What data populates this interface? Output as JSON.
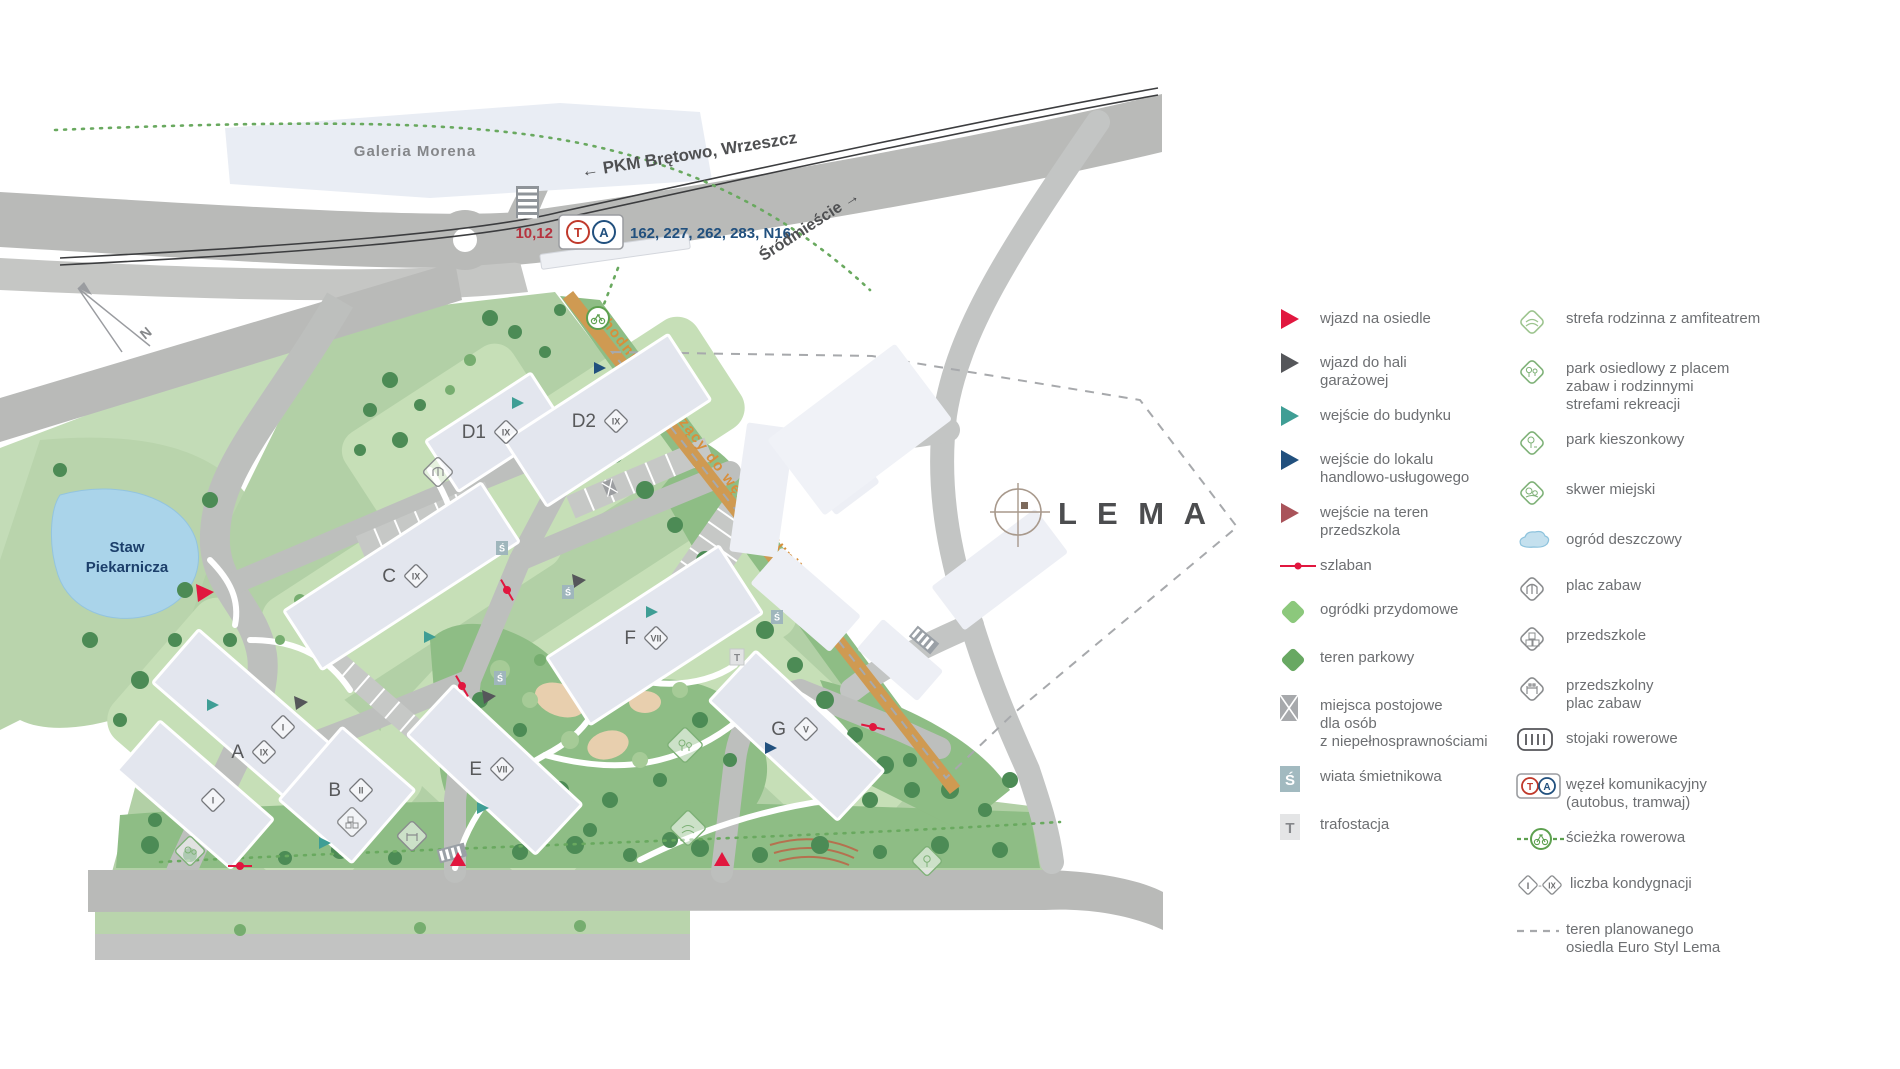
{
  "glyphs": {
    "s": "Ś",
    "t": "T",
    "i": "I",
    "ix": "IX",
    "dash": "-"
  },
  "map": {
    "galeria_label": "Galeria Morena",
    "pkm_label": "← PKM Brętowo, Wrzeszcz",
    "srodmiescie_label": "Śródmieście →",
    "pond_label_line1": "Staw",
    "pond_label_line2": "Piekarnicza",
    "tram_numbers": "10,12",
    "bus_numbers": "162, 227, 262, 283, N16",
    "hub_t": "T",
    "hub_a": "A",
    "walkway_label": "chodnik prowadzący do węzła komunikacyjnego",
    "lema_logo": "L E M A",
    "compass_n": "N",
    "wing_storeys": "I",
    "buildings": [
      {
        "name": "A",
        "storeys": "IX"
      },
      {
        "name": "B",
        "storeys": "II"
      },
      {
        "name": "C",
        "storeys": "IX"
      },
      {
        "name": "D1",
        "storeys": "IX"
      },
      {
        "name": "D2",
        "storeys": "IX"
      },
      {
        "name": "E",
        "storeys": "VII"
      },
      {
        "name": "F",
        "storeys": "VII"
      },
      {
        "name": "G",
        "storeys": "V"
      }
    ]
  },
  "legend": {
    "column1": [
      {
        "label": "wjazd na osiedle"
      },
      {
        "label": "wjazd do hali\ngarażowej"
      },
      {
        "label": "wejście do budynku"
      },
      {
        "label": "wejście do lokalu\nhandlowo-usługowego"
      },
      {
        "label": "wejście na teren\nprzedszkola"
      },
      {
        "label": "szlaban"
      },
      {
        "label": "ogródki przydomowe"
      },
      {
        "label": "teren parkowy"
      },
      {
        "label": "miejsca postojowe\ndla osób\nz niepełnosprawnościami"
      },
      {
        "label": "wiata śmietnikowa"
      },
      {
        "label": "trafostacja"
      }
    ],
    "column2": [
      {
        "label": "strefa rodzinna z amfiteatrem"
      },
      {
        "label": "park osiedlowy z placem\nzabaw i rodzinnymi\nstrefami rekreacji"
      },
      {
        "label": "park kieszonkowy"
      },
      {
        "label": "skwer miejski"
      },
      {
        "label": "ogród deszczowy"
      },
      {
        "label": "plac zabaw"
      },
      {
        "label": "przedszkole"
      },
      {
        "label": "przedszkolny\nplac zabaw"
      },
      {
        "label": "stojaki rowerowe"
      },
      {
        "label": "węzeł komunikacyjny\n(autobus, tramwaj)"
      },
      {
        "label": "ścieżka rowerowa"
      },
      {
        "label": "liczba kondygnacji"
      },
      {
        "label": "teren planowanego\nosiedla Euro Styl Lema"
      }
    ]
  },
  "colors": {
    "accent_red": "#E1173F",
    "dark_gray": "#55565A",
    "teal": "#3F9E95",
    "navy": "#21507E",
    "brick": "#A9535A",
    "light_green": "#8CC87C",
    "park_green": "#68A862",
    "orange": "#D2914A",
    "water": "#A9D4EA"
  }
}
